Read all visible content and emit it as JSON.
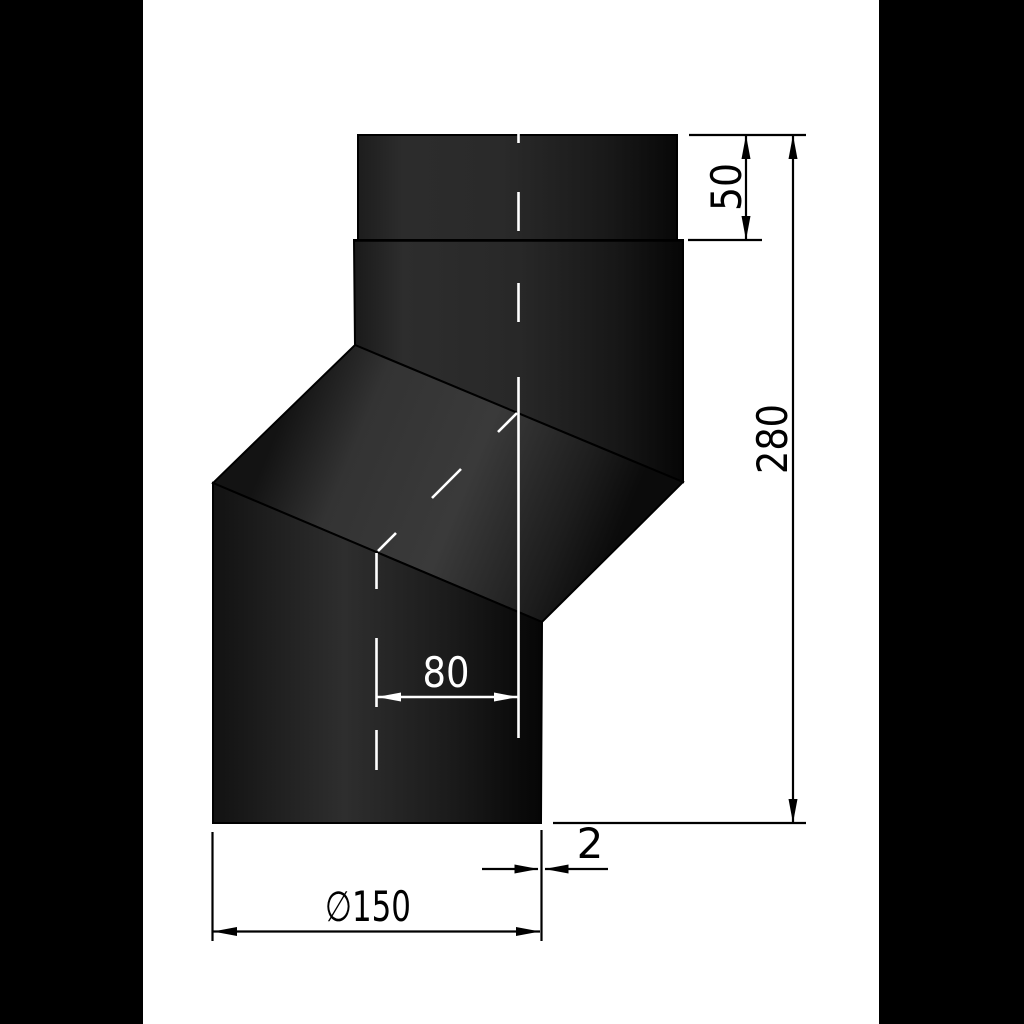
{
  "drawing": {
    "dimensions": {
      "collar_height": "50",
      "total_height": "280",
      "offset": "80",
      "rim_offset": "2",
      "diameter": "∅150"
    },
    "colors": {
      "letterbox_bars": "#000000",
      "canvas": "#ffffff",
      "pipe_dark": "#0a0a0a",
      "pipe_mid": "#2e2e2e",
      "offset_highlight": "#3a3a3a",
      "dimension_ink": "#000000",
      "centerline_ink": "#ffffff"
    }
  }
}
